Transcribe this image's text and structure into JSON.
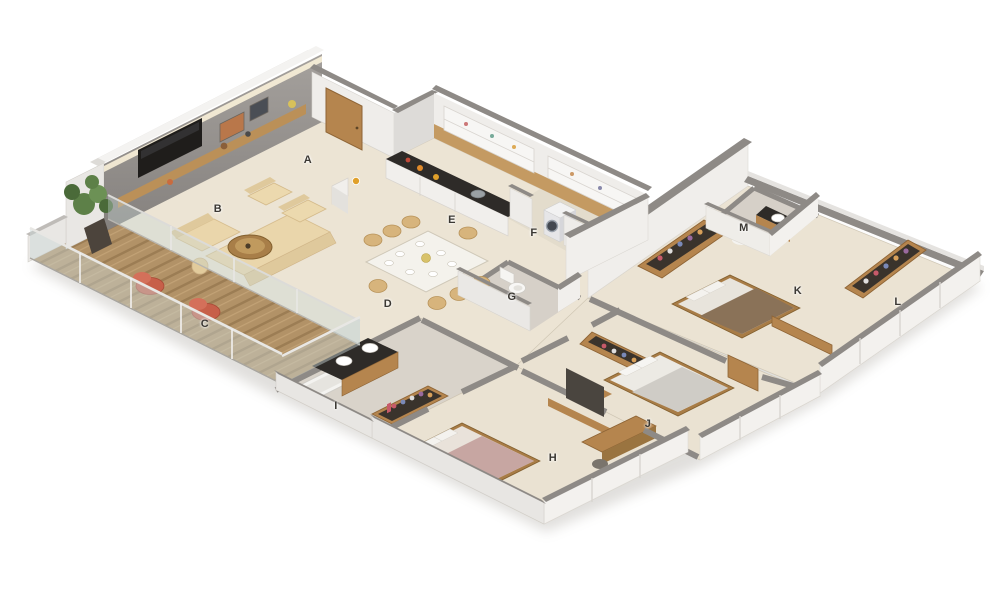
{
  "scene": {
    "type": "isometric-3d-floor-plan-render",
    "background": "#ffffff",
    "description": "3BHK apartment 3D floor plan, rooms annotated with letters"
  },
  "room_labels": {
    "a": "A",
    "b": "B",
    "c": "C",
    "d": "D",
    "e": "E",
    "f": "F",
    "g": "G",
    "h": "H",
    "i": "I",
    "j": "J",
    "k": "K",
    "l": "L",
    "m": "M"
  },
  "palette": {
    "floor_cream": "#ece4d4",
    "floor_tile_gray": "#d6d0c8",
    "floor_tile_tan": "#e3dccc",
    "deck_wood": "#b29267",
    "wall_cap_gray": "#8e8a86",
    "wall_face_white": "#f0eeeb",
    "feature_wall_gray": "#8f8c89",
    "counter_dark": "#2e2b28",
    "wood_accent": "#b5854e",
    "sofa_beige": "#ead6ab",
    "dining_chair_tan": "#d7b47c",
    "accent_chair_red": "#c75f49",
    "plant_green": "#5d8048",
    "bed_mauve": "#c7a6a2",
    "bed_gray": "#cfccc6",
    "glass": "#c9d8d6",
    "label_text": "#3b3833"
  }
}
